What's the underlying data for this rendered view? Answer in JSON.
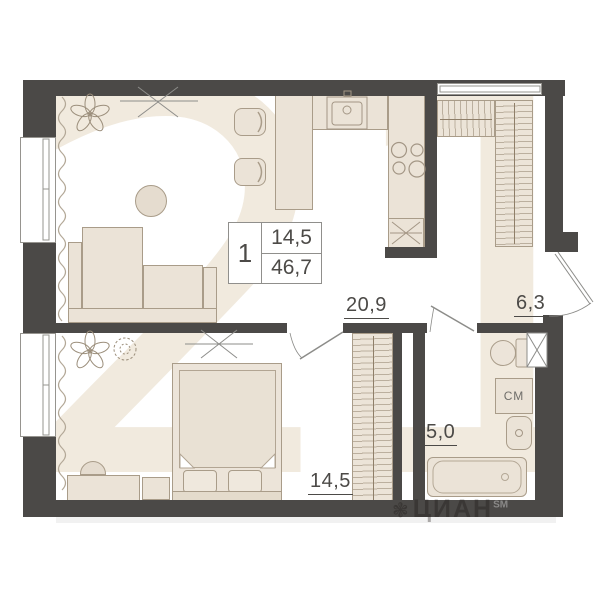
{
  "info_box": {
    "rooms_count": "1",
    "living_area": "14,5",
    "total_area": "46,7"
  },
  "labels": {
    "living_kitchen": "20,9",
    "hallway": "6,3",
    "bedroom": "14,5",
    "bathroom": "5,0"
  },
  "appliances": {
    "washer_label": "СМ"
  },
  "watermarks": {
    "big": "21",
    "brand_icon": "❃",
    "brand": "ЦИАН",
    "brand_sup": "SM"
  },
  "colors": {
    "wall": "#4b4947",
    "furniture_fill": "#ebe3d7",
    "furniture_stroke": "#a99c89",
    "text": "#4c4a47",
    "watermark": "#f1eade"
  }
}
